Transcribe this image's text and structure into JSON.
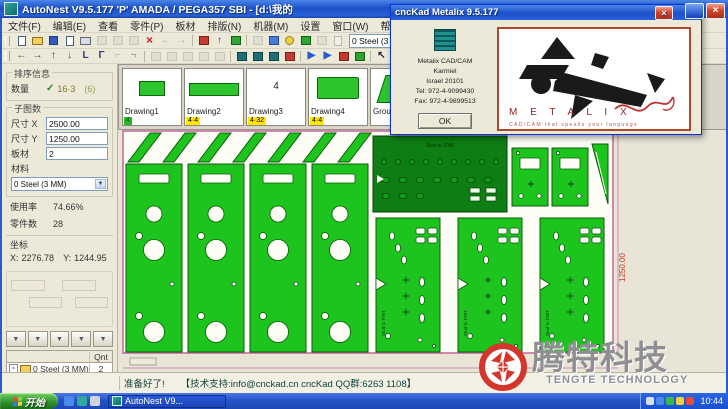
{
  "window": {
    "title": "AutoNest V9.5.177   'P'   AMADA / PEGA357   SBI    - [d:\\我的",
    "about_title": "cncKad Metalix   9.5.177"
  },
  "menu": {
    "items": [
      "文件(F)",
      "编辑(E)",
      "查看",
      "零件(P)",
      "板材",
      "排版(N)",
      "机器(M)",
      "设置",
      "窗口(W)",
      "帮助(H)"
    ]
  },
  "toolbar": {
    "material_combo": "0  Steel  (3 MM)"
  },
  "sidebar": {
    "info_group": "排序信息",
    "qty_label": "数量",
    "qty_value": "16·3",
    "qty_extra": "(6)",
    "sub_group": "子图数",
    "size_x_label": "尺寸 X",
    "size_x": "2500.00",
    "size_y_label": "尺寸 Y",
    "size_y": "1250.00",
    "sheets_label": "板材",
    "sheets": "2",
    "material_label": "材料",
    "material": "0  Steel  (3 MM)",
    "util_label": "使用率",
    "util": "74.66%",
    "parts_label": "零件数",
    "parts": "28",
    "coord_label": "坐标",
    "x_label": "X:",
    "x": "2276.78",
    "y_label": "Y:",
    "y": "1244.95",
    "table": {
      "qnt": "Qnt",
      "rows": [
        {
          "chip": "",
          "label": "0  Steel  (3 MM)",
          "qnt": "2"
        },
        {
          "chip": "25",
          "label": "(1) 2500 1",
          "qnt": "2"
        },
        {
          "chip": "",
          "label": "Total qnt",
          "qnt": "2"
        }
      ]
    }
  },
  "thumbs": {
    "items": [
      {
        "label": "Drawing1",
        "badge": "4"
      },
      {
        "label": "Drawing2",
        "badge": "4·4"
      },
      {
        "label": "Drawing3",
        "badge": "4·32",
        "mark": "4"
      },
      {
        "label": "Drawing4",
        "badge": "4·4"
      },
      {
        "label": "Group",
        "badge": ""
      }
    ]
  },
  "canvas": {
    "dim_right": "1250.00",
    "dark_part_label": "Stud to 2000",
    "panel_label": "Stud to T00T"
  },
  "about": {
    "lines": [
      "Metalix CAD/CAM",
      "Karmiel",
      "Israel 20101",
      "Tel: 972-4-9099430",
      "Fax: 972-4-9899513"
    ],
    "ok": "OK",
    "brand": "M E T A L I X",
    "tagline": "CAD/CAM  that  speaks  your  language"
  },
  "status": {
    "ready": "准备好了!",
    "support": "【技术支持:info@cnckad.cn   cncKad QQ群:6263 1108】"
  },
  "taskbar": {
    "start": "开始",
    "task": "AutoNest V9...",
    "time": "10:44"
  },
  "watermark": {
    "cn": "腾特科技",
    "en": "TENGTE TECHNOLOGY"
  },
  "colors": {
    "part_green": "#1dc41d",
    "dark_part_green": "#0e7d13",
    "sheet_border_magenta": "#c2679b",
    "dimension_red": "#cc3a1a",
    "brand_red": "#8a2525",
    "watermark_red": "#d5352b",
    "taskbar_blue": "#2453c6",
    "badge_yellow": "#ffe600"
  }
}
